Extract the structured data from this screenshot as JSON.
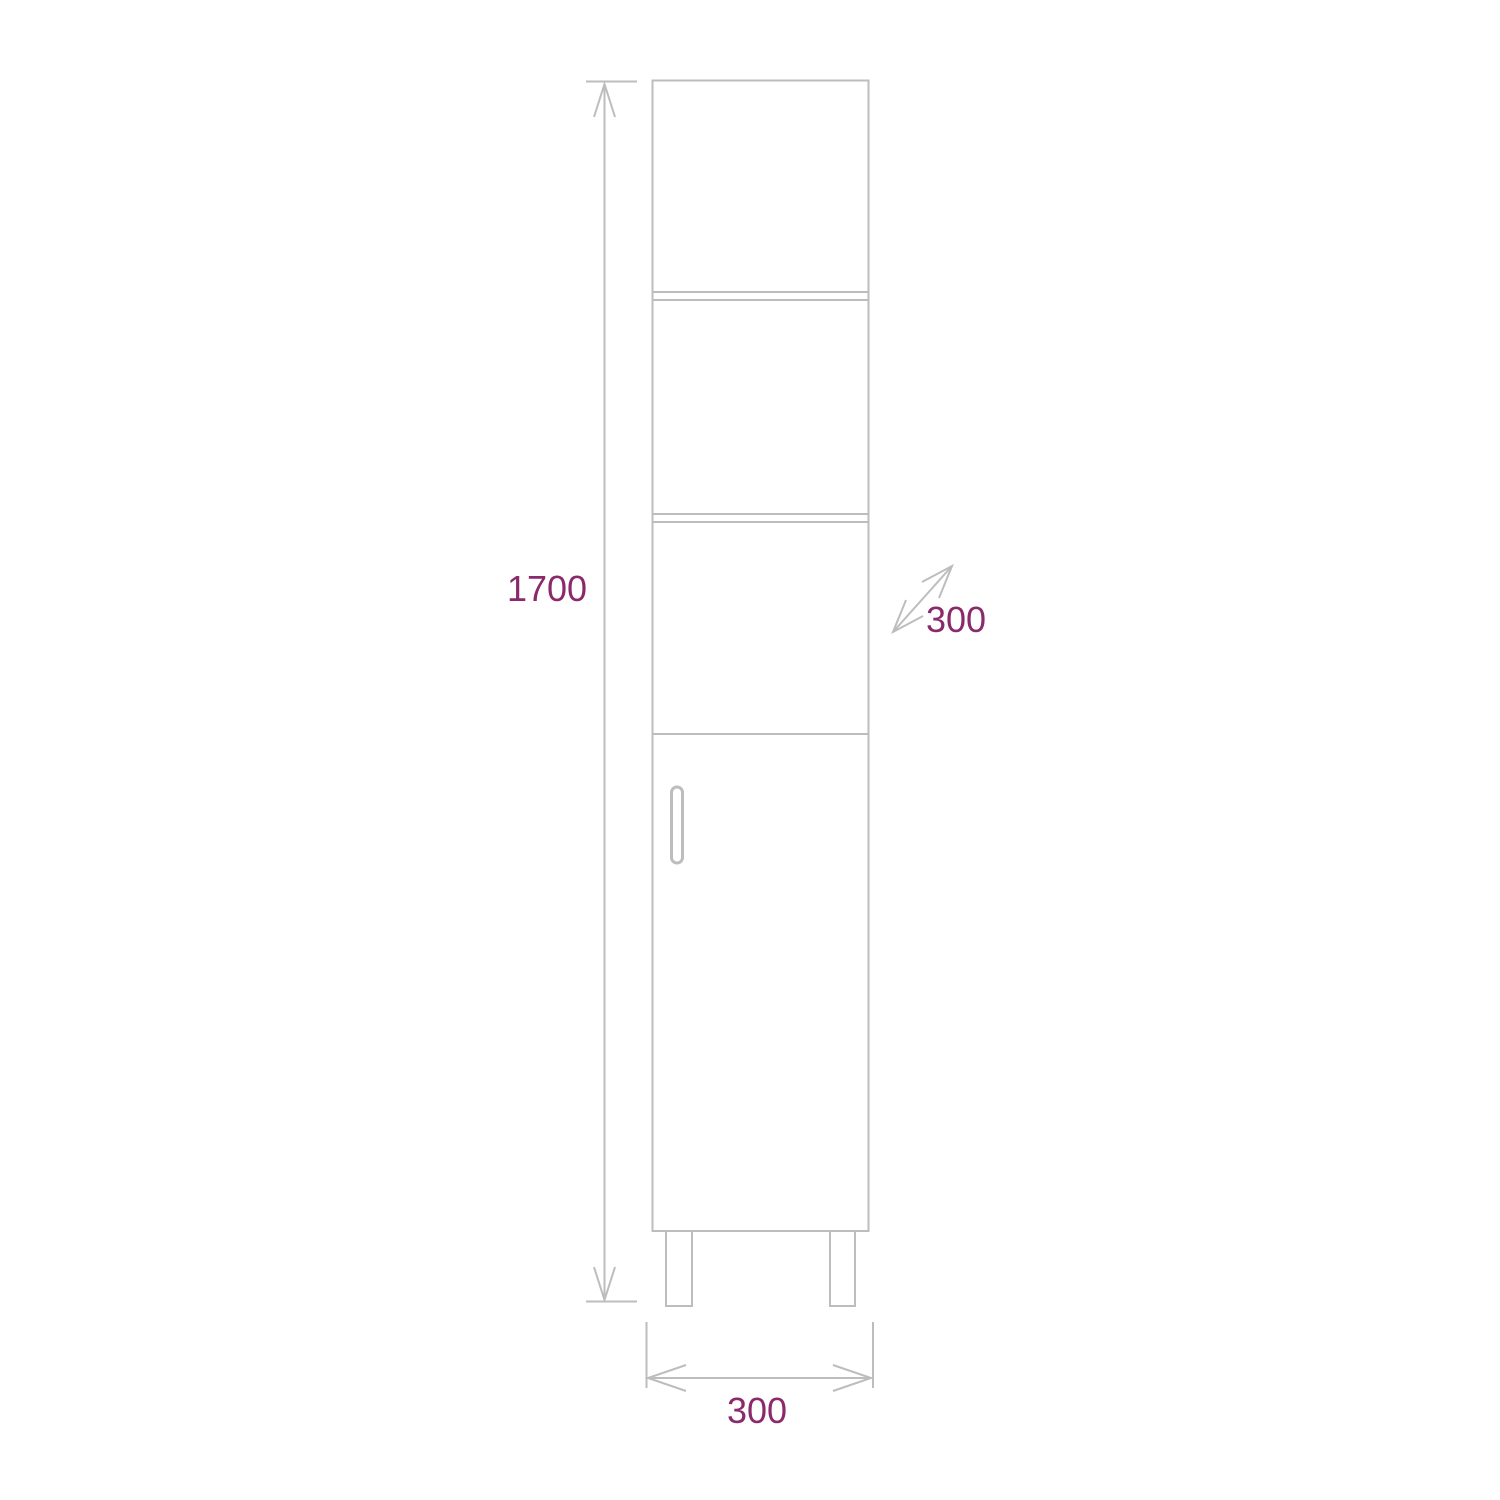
{
  "diagram": {
    "kind": "cabinet-dimension-drawing",
    "colors": {
      "background": "#ffffff",
      "line": "#bdbdbd",
      "dimension_text": "#8b2a6b"
    },
    "dimensions": {
      "height": "1700",
      "depth": "300",
      "width": "300"
    }
  }
}
